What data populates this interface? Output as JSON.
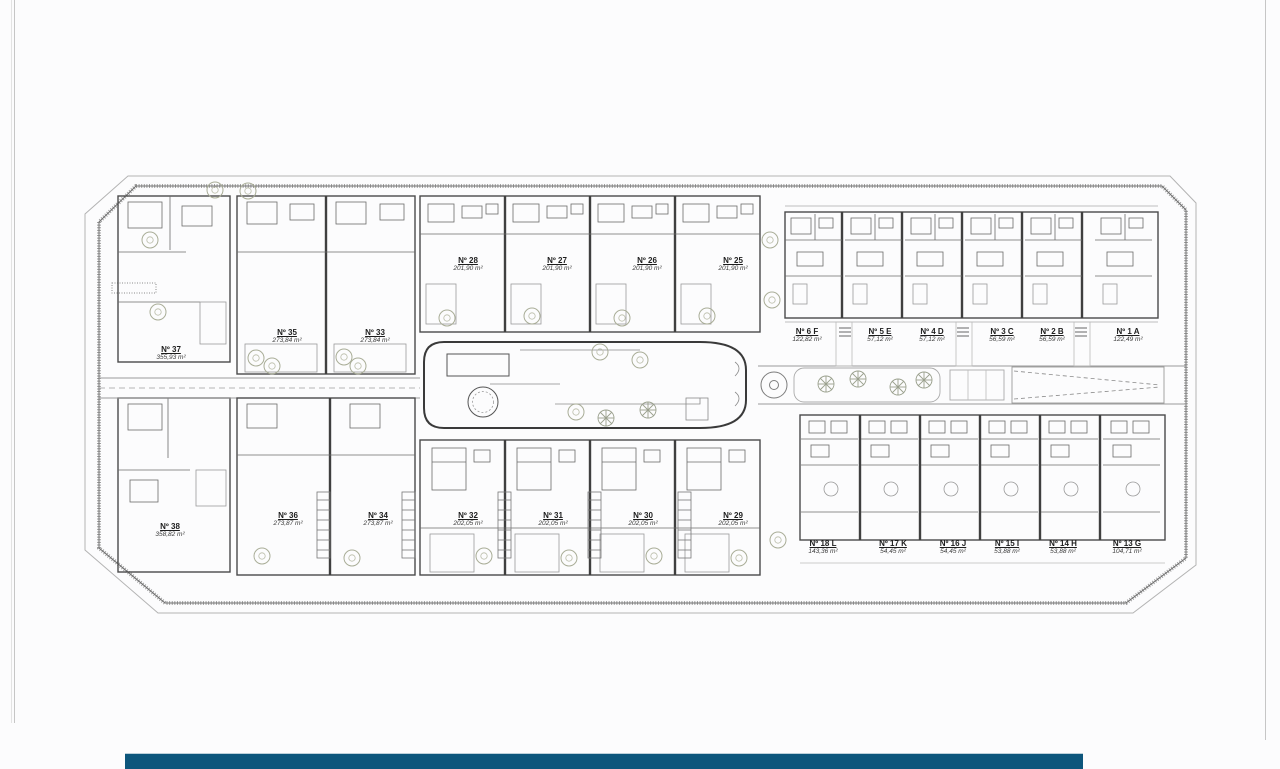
{
  "page": {
    "background": "#fcfcfd"
  },
  "colors": {
    "footer_bar": "#0d567c",
    "walls": "#3f3f3f",
    "light_lines": "#9a9a9a",
    "greenery": "#a9ad97"
  },
  "icons": {
    "tree": "tree-icon",
    "palm": "palm-tree-icon",
    "stairs": "stairs-icon",
    "ladder": "ladder-stairs-icon",
    "roundabout": "roundabout-icon"
  },
  "plan": {
    "units": [
      {
        "number": "Nº 37",
        "area": "355,93 m²"
      },
      {
        "number": "Nº 35",
        "area": "273,84 m²"
      },
      {
        "number": "Nº 33",
        "area": "273,84 m²"
      },
      {
        "number": "Nº 28",
        "area": "201,90 m²"
      },
      {
        "number": "Nº 27",
        "area": "201,90 m²"
      },
      {
        "number": "Nº 26",
        "area": "201,90 m²"
      },
      {
        "number": "Nº 25",
        "area": "201,90 m²"
      },
      {
        "number": "Nº 6 F",
        "area": "122,82 m²"
      },
      {
        "number": "Nº 5 E",
        "area": "57,12 m²"
      },
      {
        "number": "Nº 4 D",
        "area": "57,12 m²"
      },
      {
        "number": "Nº 3 C",
        "area": "56,59 m²"
      },
      {
        "number": "Nº 2 B",
        "area": "56,59 m²"
      },
      {
        "number": "Nº 1 A",
        "area": "122,49 m²"
      },
      {
        "number": "Nº 38",
        "area": "358,82 m²"
      },
      {
        "number": "Nº 36",
        "area": "273,87 m²"
      },
      {
        "number": "Nº 34",
        "area": "273,87 m²"
      },
      {
        "number": "Nº 32",
        "area": "202,05 m²"
      },
      {
        "number": "Nº 31",
        "area": "202,05 m²"
      },
      {
        "number": "Nº 30",
        "area": "202,05 m²"
      },
      {
        "number": "Nº 29",
        "area": "202,05 m²"
      },
      {
        "number": "Nº 18 L",
        "area": "143,36 m²"
      },
      {
        "number": "Nº 17 K",
        "area": "54,45 m²"
      },
      {
        "number": "Nº 16 J",
        "area": "54,45 m²"
      },
      {
        "number": "Nº 15 I",
        "area": "53,88 m²"
      },
      {
        "number": "Nº 14 H",
        "area": "53,88 m²"
      },
      {
        "number": "Nº 13 G",
        "area": "104,71 m²"
      }
    ]
  }
}
